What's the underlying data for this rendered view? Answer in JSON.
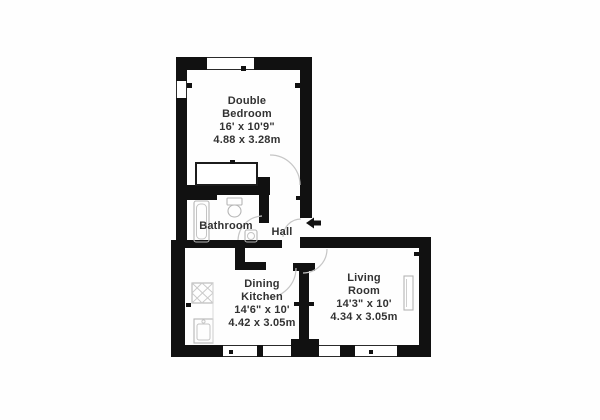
{
  "plan_title": "Flat floor plan",
  "colors": {
    "wall": "#111111",
    "label_text": "#323232",
    "fixture_line": "#b5b5b5",
    "door_arc": "#c6c6c6",
    "background": "#fefefe"
  },
  "rooms": {
    "bedroom": {
      "name_line1": "Double",
      "name_line2": "Bedroom",
      "dims_imperial": "16' x 10'9\"",
      "dims_metric": "4.88 x 3.28m"
    },
    "bathroom": {
      "name": "Bathroom"
    },
    "hall": {
      "name": "Hall"
    },
    "kitchen": {
      "name_line1": "Dining",
      "name_line2": "Kitchen",
      "dims_imperial": "14'6\" x 10'",
      "dims_metric": "4.42 x 3.05m"
    },
    "living": {
      "name_line1": "Living",
      "name_line2": "Room",
      "dims_imperial": "14'3\" x 10'",
      "dims_metric": "4.34 x 3.05m"
    }
  },
  "icons": {
    "entrance_arrow": "left-arrow"
  }
}
